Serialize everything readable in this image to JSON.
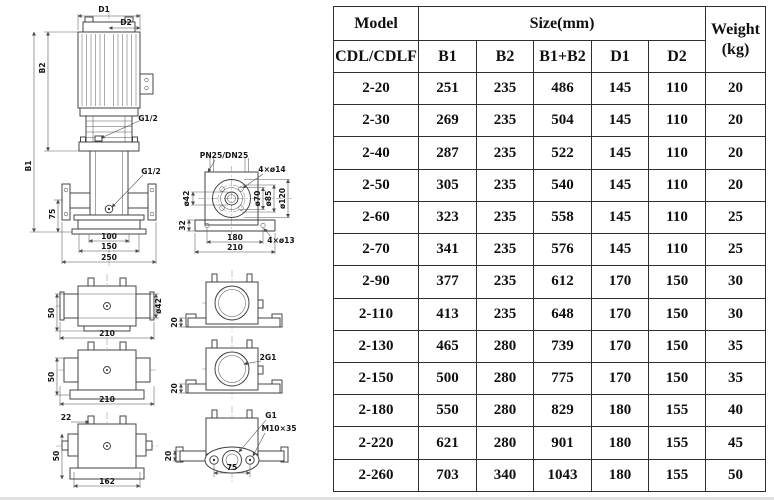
{
  "table": {
    "title_model": "Model",
    "title_size": "Size(mm)",
    "title_weight_1": "Weight",
    "title_weight_2": "(kg)",
    "sub_model": "CDL/CDLF",
    "columns": [
      "B1",
      "B2",
      "B1+B2",
      "D1",
      "D2"
    ],
    "rows": [
      [
        "2-20",
        "251",
        "235",
        "486",
        "145",
        "110",
        "20"
      ],
      [
        "2-30",
        "269",
        "235",
        "504",
        "145",
        "110",
        "20"
      ],
      [
        "2-40",
        "287",
        "235",
        "522",
        "145",
        "110",
        "20"
      ],
      [
        "2-50",
        "305",
        "235",
        "540",
        "145",
        "110",
        "20"
      ],
      [
        "2-60",
        "323",
        "235",
        "558",
        "145",
        "110",
        "25"
      ],
      [
        "2-70",
        "341",
        "235",
        "576",
        "145",
        "110",
        "25"
      ],
      [
        "2-90",
        "377",
        "235",
        "612",
        "170",
        "150",
        "30"
      ],
      [
        "2-110",
        "413",
        "235",
        "648",
        "170",
        "150",
        "30"
      ],
      [
        "2-130",
        "465",
        "280",
        "739",
        "170",
        "150",
        "35"
      ],
      [
        "2-150",
        "500",
        "280",
        "775",
        "170",
        "150",
        "35"
      ],
      [
        "2-180",
        "550",
        "280",
        "829",
        "180",
        "155",
        "40"
      ],
      [
        "2-220",
        "621",
        "280",
        "901",
        "180",
        "155",
        "45"
      ],
      [
        "2-260",
        "703",
        "340",
        "1043",
        "180",
        "155",
        "50"
      ]
    ]
  },
  "drawing": {
    "front_view": {
      "d1": "D1",
      "d2": "D2",
      "b1": "B1",
      "b2": "B2",
      "g12_top": "G1/2",
      "g12_mid": "G1/2",
      "dim_75": "75",
      "dim_100": "100",
      "dim_150": "150",
      "dim_250": "250"
    },
    "flange_view": {
      "pn": "PN25/DN25",
      "bolt_holes": "4×ø14",
      "base_holes": "4×ø13",
      "d_pipe": "ø42",
      "d_70": "ø70",
      "d_85": "ø85",
      "d_120": "ø120",
      "dim_32": "32",
      "dim_180": "180",
      "dim_210": "210"
    },
    "side_view_1": {
      "dim_50": "50",
      "dim_210": "210",
      "d_pipe": "ø42"
    },
    "side_view_2": {
      "dim_50": "50",
      "dim_210": "210"
    },
    "bottom_left_view": {
      "dim_22": "22",
      "dim_50": "50",
      "dim_162": "162"
    },
    "right_view_1": {
      "dim_20": "20"
    },
    "right_view_2": {
      "port": "2G1",
      "dim_20": "20"
    },
    "right_view_3": {
      "port": "G1",
      "bolt": "M10×35",
      "dim_75": "75",
      "dim_20": "20"
    }
  }
}
